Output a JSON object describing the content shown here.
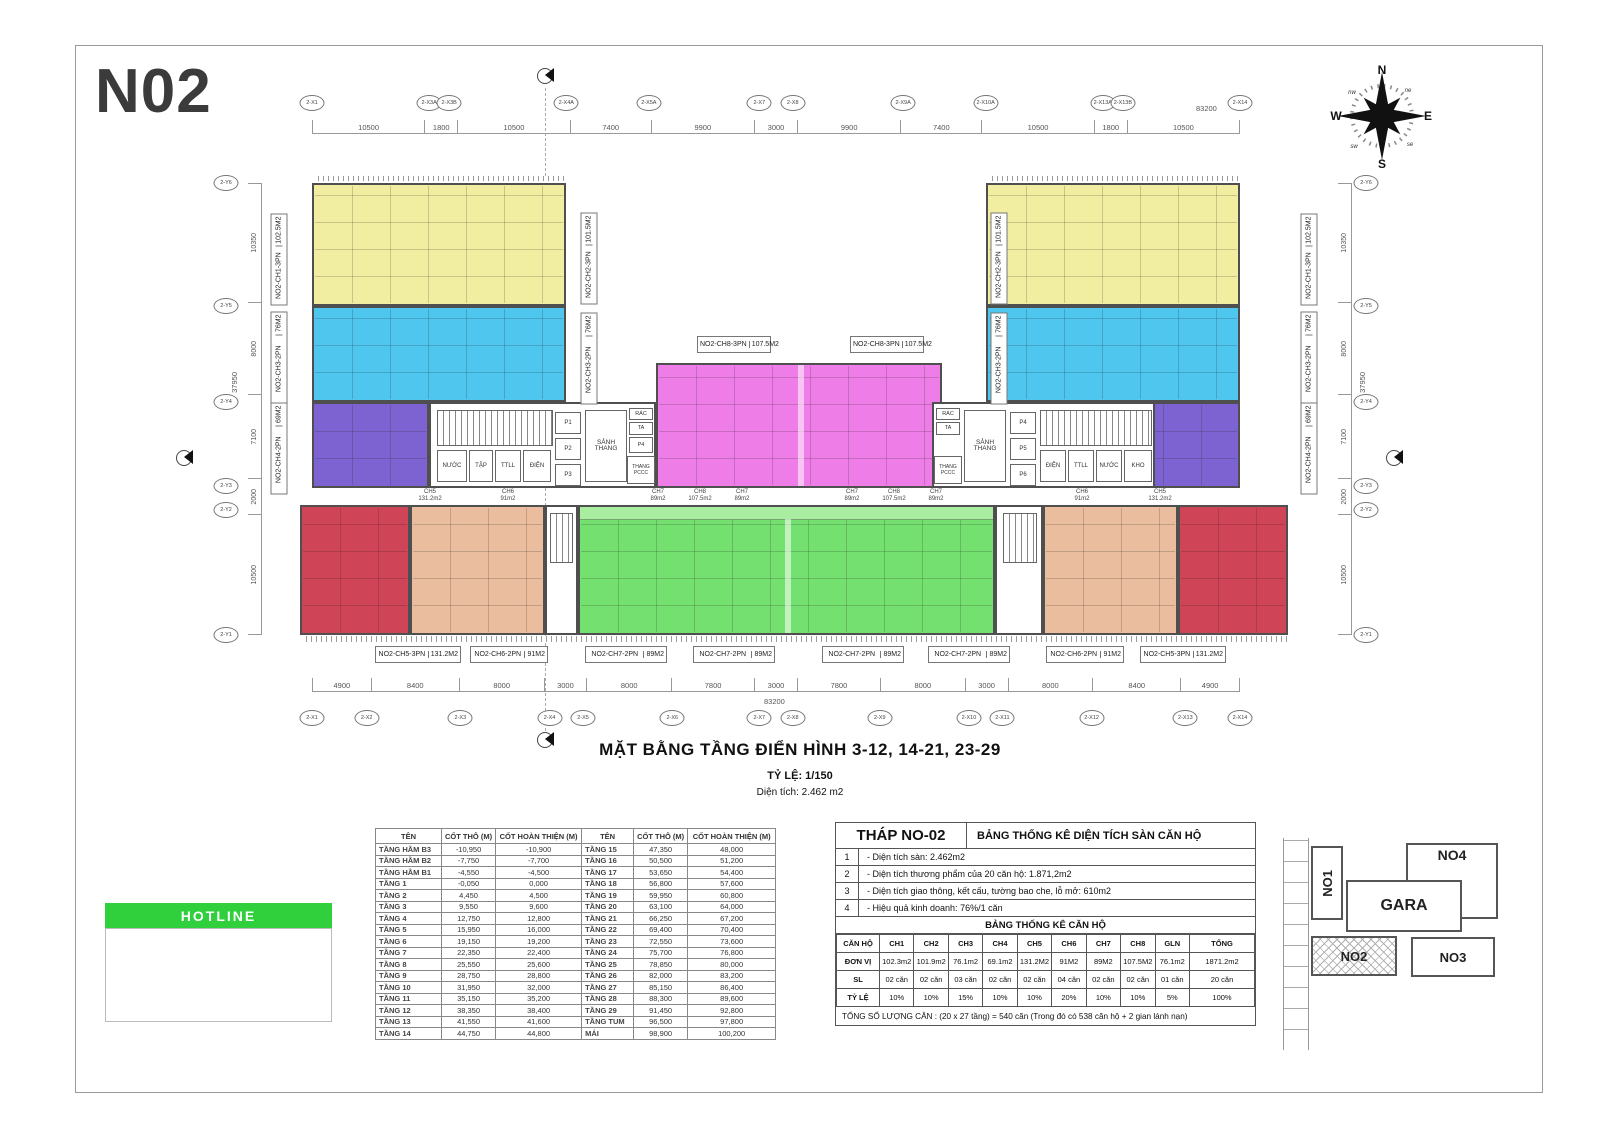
{
  "logo": "N02",
  "compass": {
    "n": "N",
    "e": "E",
    "s": "S",
    "w": "W",
    "ne": "ne",
    "se": "se",
    "sw": "sw",
    "nw": "nw"
  },
  "colors": {
    "yellow": "#f1eda1",
    "blue": "#4fc6ee",
    "purple": "#7d63d1",
    "pink": "#ef7de7",
    "red": "#d04458",
    "salmon": "#eabd9e",
    "green": "#74e070",
    "green_light": "#a9eda1",
    "wall": "#4f4f4f",
    "hotline_green": "#2fd03c"
  },
  "plan": {
    "title": "MẶT BẰNG TẦNG ĐIỂN HÌNH 3-12, 14-21, 23-29",
    "scale": "TỶ LỆ: 1/150",
    "area": "Diện tích: 2.462 m2",
    "total_width": "83200",
    "total_height": "37950",
    "top_dims": [
      "10500",
      "1800",
      "10500",
      "7400",
      "9900",
      "3000",
      "9900",
      "7400",
      "10500",
      "1800",
      "10500"
    ],
    "bottom_dims": [
      "4900",
      "8400",
      "8000",
      "3000",
      "8000",
      "7800",
      "3000",
      "7800",
      "8000",
      "3000",
      "8000",
      "8400",
      "4900"
    ],
    "left_dims": [
      "10350",
      "8000",
      "7100",
      "2000",
      "10500"
    ],
    "right_dims": [
      "10350",
      "8000",
      "7100",
      "2000",
      "10500"
    ],
    "top_grid_labels": [
      "2-X1",
      "2-X3A",
      "2-X3B",
      "2-X4A",
      "2-X5A",
      "2-X7",
      "2-X8",
      "2-X9A",
      "2-X10A",
      "2-X13A",
      "2-X13B",
      "2-X14"
    ],
    "bottom_grid_labels": [
      "2-X1",
      "2-X2",
      "2-X3",
      "2-X4",
      "2-X5",
      "2-X6",
      "2-X7",
      "2-X8",
      "2-X9",
      "2-X10",
      "2-X11",
      "2-X12",
      "2-X13",
      "2-X14"
    ],
    "left_grid_labels": [
      "2-Y6",
      "2-Y5",
      "2-Y4",
      "2-Y3",
      "2-Y2",
      "2-Y1"
    ],
    "right_grid_labels": [
      "2-Y6",
      "2-Y5",
      "2-Y4",
      "2-Y3",
      "2-Y2",
      "2-Y1"
    ],
    "corridor": [
      {
        "n": "CH5",
        "a": "131.2m2"
      },
      {
        "n": "CH6",
        "a": "91m2"
      },
      {
        "n": "CH7",
        "a": "89m2"
      },
      {
        "n": "CH8",
        "a": "107.5m2"
      },
      {
        "n": "CH7",
        "a": "89m2"
      },
      {
        "n": "CH7",
        "a": "89m2"
      },
      {
        "n": "CH8",
        "a": "107.5m2"
      },
      {
        "n": "CH7",
        "a": "89m2"
      },
      {
        "n": "CH6",
        "a": "91m2"
      },
      {
        "n": "CH5",
        "a": "131.2m2"
      }
    ]
  },
  "units": {
    "ch1": {
      "name": "NO2-CH1-3PN",
      "area": "102.5M2"
    },
    "ch2": {
      "name": "NO2-CH2-3PN",
      "area": "101.5M2"
    },
    "ch3": {
      "name": "NO2-CH3-2PN",
      "area": "76M2"
    },
    "ch4": {
      "name": "NO2-CH4-2PN",
      "area": "69M2"
    },
    "ch5": {
      "name": "NO2-CH5-3PN",
      "area": "131.2M2"
    },
    "ch6": {
      "name": "NO2-CH6-2PN",
      "area": "91M2"
    },
    "ch7": {
      "name": "NO2-CH7-2PN",
      "area": "89M2"
    },
    "ch8": {
      "name": "NO2-CH8-3PN",
      "area": "107.5M2"
    }
  },
  "core": {
    "nuoc": "NƯỚC",
    "tap": "TẬP",
    "ttll": "TTLL",
    "dien": "ĐIỆN",
    "sanh_thang": "SẢNH THANG",
    "ta": "TA",
    "rac": "RÁC",
    "thang_pccc": "THANG PCCC",
    "kho": "KHO",
    "p1": "P1",
    "p2": "P2",
    "p3": "P3",
    "p4": "P4",
    "p5": "P5",
    "p6": "P6"
  },
  "hotline": {
    "label": "HOTLINE"
  },
  "elevation_table": {
    "headers": [
      "TÊN",
      "CỐT THÔ (M)",
      "CỐT HOÀN THIỆN (M)",
      "TÊN",
      "CỐT THÔ (M)",
      "CỐT HOÀN THIỆN (M)"
    ],
    "left_rows": [
      [
        "TẦNG HẦM B3",
        "-10,950",
        "-10,900"
      ],
      [
        "TẦNG HẦM B2",
        "-7,750",
        "-7,700"
      ],
      [
        "TẦNG HẦM B1",
        "-4,550",
        "-4,500"
      ],
      [
        "TẦNG 1",
        "-0,050",
        "0,000"
      ],
      [
        "TẦNG 2",
        "4,450",
        "4,500"
      ],
      [
        "TẦNG 3",
        "9,550",
        "9,600"
      ],
      [
        "TẦNG 4",
        "12,750",
        "12,800"
      ],
      [
        "TẦNG 5",
        "15,950",
        "16,000"
      ],
      [
        "TẦNG 6",
        "19,150",
        "19,200"
      ],
      [
        "TẦNG 7",
        "22,350",
        "22,400"
      ],
      [
        "TẦNG 8",
        "25,550",
        "25,600"
      ],
      [
        "TẦNG 9",
        "28,750",
        "28,800"
      ],
      [
        "TẦNG 10",
        "31,950",
        "32,000"
      ],
      [
        "TẦNG 11",
        "35,150",
        "35,200"
      ],
      [
        "TẦNG 12",
        "38,350",
        "38,400"
      ],
      [
        "TẦNG 13",
        "41,550",
        "41,600"
      ],
      [
        "TẦNG 14",
        "44,750",
        "44,800"
      ]
    ],
    "right_rows": [
      [
        "TẦNG 15",
        "47,350",
        "48,000"
      ],
      [
        "TẦNG 16",
        "50,500",
        "51,200"
      ],
      [
        "TẦNG 17",
        "53,650",
        "54,400"
      ],
      [
        "TẦNG 18",
        "56,800",
        "57,600"
      ],
      [
        "TẦNG 19",
        "59,950",
        "60,800"
      ],
      [
        "TẦNG 20",
        "63,100",
        "64,000"
      ],
      [
        "TẦNG 21",
        "66,250",
        "67,200"
      ],
      [
        "TẦNG 22",
        "69,400",
        "70,400"
      ],
      [
        "TẦNG 23",
        "72,550",
        "73,600"
      ],
      [
        "TẦNG 24",
        "75,700",
        "76,800"
      ],
      [
        "TẦNG 25",
        "78,850",
        "80,000"
      ],
      [
        "TẦNG 26",
        "82,000",
        "83,200"
      ],
      [
        "TẦNG 27",
        "85,150",
        "86,400"
      ],
      [
        "TẦNG 28",
        "88,300",
        "89,600"
      ],
      [
        "TẦNG 29",
        "91,450",
        "92,800"
      ],
      [
        "TẦNG TUM",
        "96,500",
        "97,800"
      ],
      [
        "MÁI",
        "98,900",
        "100,200"
      ]
    ]
  },
  "stats_table": {
    "tower": "THÁP NO-02",
    "title": "BẢNG THỐNG KÊ DIỆN TÍCH SÀN CĂN HỘ",
    "notes": [
      [
        "1",
        "- Diện tích sàn: 2.462m2"
      ],
      [
        "2",
        "- Diện tích thương phẩm của 20 căn hộ: 1.871,2m2"
      ],
      [
        "3",
        "- Diện tích giao thông, kết cấu, tường bao che, lỗ mở: 610m2"
      ],
      [
        "4",
        "- Hiệu quả kinh doanh: 76%/1 căn"
      ]
    ],
    "sub_title": "BẢNG THỐNG KÊ CĂN HỘ",
    "unit_header": [
      "CĂN HỘ",
      "CH1",
      "CH2",
      "CH3",
      "CH4",
      "CH5",
      "CH6",
      "CH7",
      "CH8",
      "GLN",
      "TỔNG"
    ],
    "unit_rows": [
      [
        "ĐƠN VỊ",
        "102.3m2",
        "101.9m2",
        "76.1m2",
        "69.1m2",
        "131.2M2",
        "91M2",
        "89M2",
        "107.5M2",
        "76.1m2",
        "1871.2m2"
      ],
      [
        "SL",
        "02 căn",
        "02 căn",
        "03 căn",
        "02 căn",
        "02 căn",
        "04 căn",
        "02 căn",
        "02 căn",
        "01 căn",
        "20 căn"
      ],
      [
        "TỶ LỆ",
        "10%",
        "10%",
        "15%",
        "10%",
        "10%",
        "20%",
        "10%",
        "10%",
        "5%",
        "100%"
      ]
    ],
    "footer": "TỔNG SỐ LƯỢNG CĂN : (20 x 27 tầng) = 540 căn (Trong đó có 538 căn hộ + 2 gian lánh nạn)"
  },
  "site_plan": {
    "no1": "NO1",
    "no2": "NO2",
    "no3": "NO3",
    "no4": "NO4",
    "gara": "GARA"
  }
}
